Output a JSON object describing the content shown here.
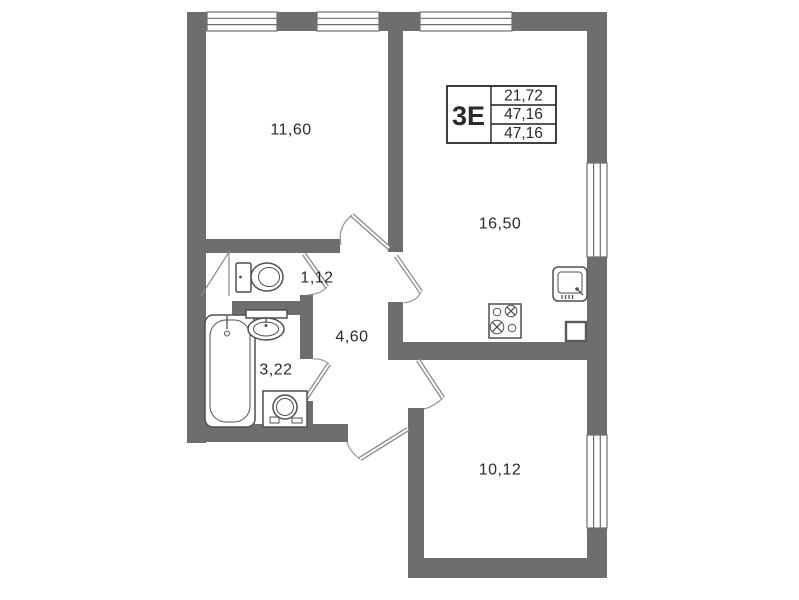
{
  "stamp": {
    "type_label": "3Е",
    "values": [
      "21,72",
      "47,16",
      "47,16"
    ]
  },
  "rooms": {
    "room_a": "11,60",
    "kitchen_living": "16,50",
    "wc": "1,12",
    "hall": "4,60",
    "bathroom": "3,22",
    "room_b": "10,12"
  },
  "colors": {
    "wall": "#6e6e6e",
    "fixture_line": "#4f4f4f",
    "door_line": "#8a8a8a",
    "text": "#2a2a2a",
    "background": "#ffffff"
  }
}
